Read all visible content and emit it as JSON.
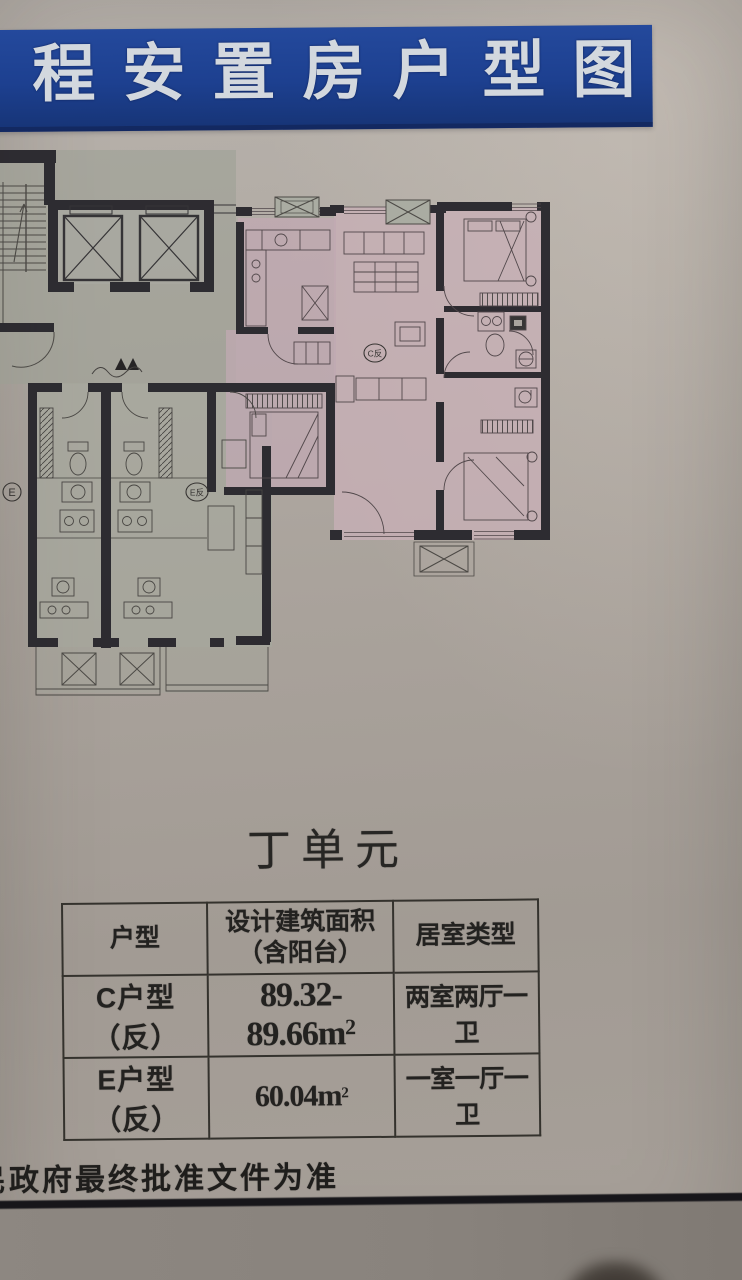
{
  "banner": {
    "partial_char": "工",
    "title": "程安置房户型图",
    "bg_color": "#1d4090",
    "text_color": "#d3d8de"
  },
  "plan": {
    "labels": {
      "c_unit": "C反",
      "e_unit": "E",
      "e_fan_unit": "E反"
    },
    "highlight_color": "#c6adb6",
    "floor_color": "#a5a79c",
    "wall_color": "#242329"
  },
  "unit_section": {
    "title": "丁单元"
  },
  "table": {
    "headers": {
      "col1": "户型",
      "col2_line1": "设计建筑面积",
      "col2_line2": "（含阳台）",
      "col3": "居室类型"
    },
    "rows": [
      {
        "type": "C户型（反）",
        "area": "89.32-89.66m",
        "area_sup": "2",
        "layout": "两室两厅一卫"
      },
      {
        "type": "E户型（反）",
        "area": "60.04m",
        "area_sup": "2",
        "layout": "一室一厅一卫"
      }
    ]
  },
  "footer": {
    "partial_char": "民",
    "note": "政府最终批准文件为准"
  }
}
